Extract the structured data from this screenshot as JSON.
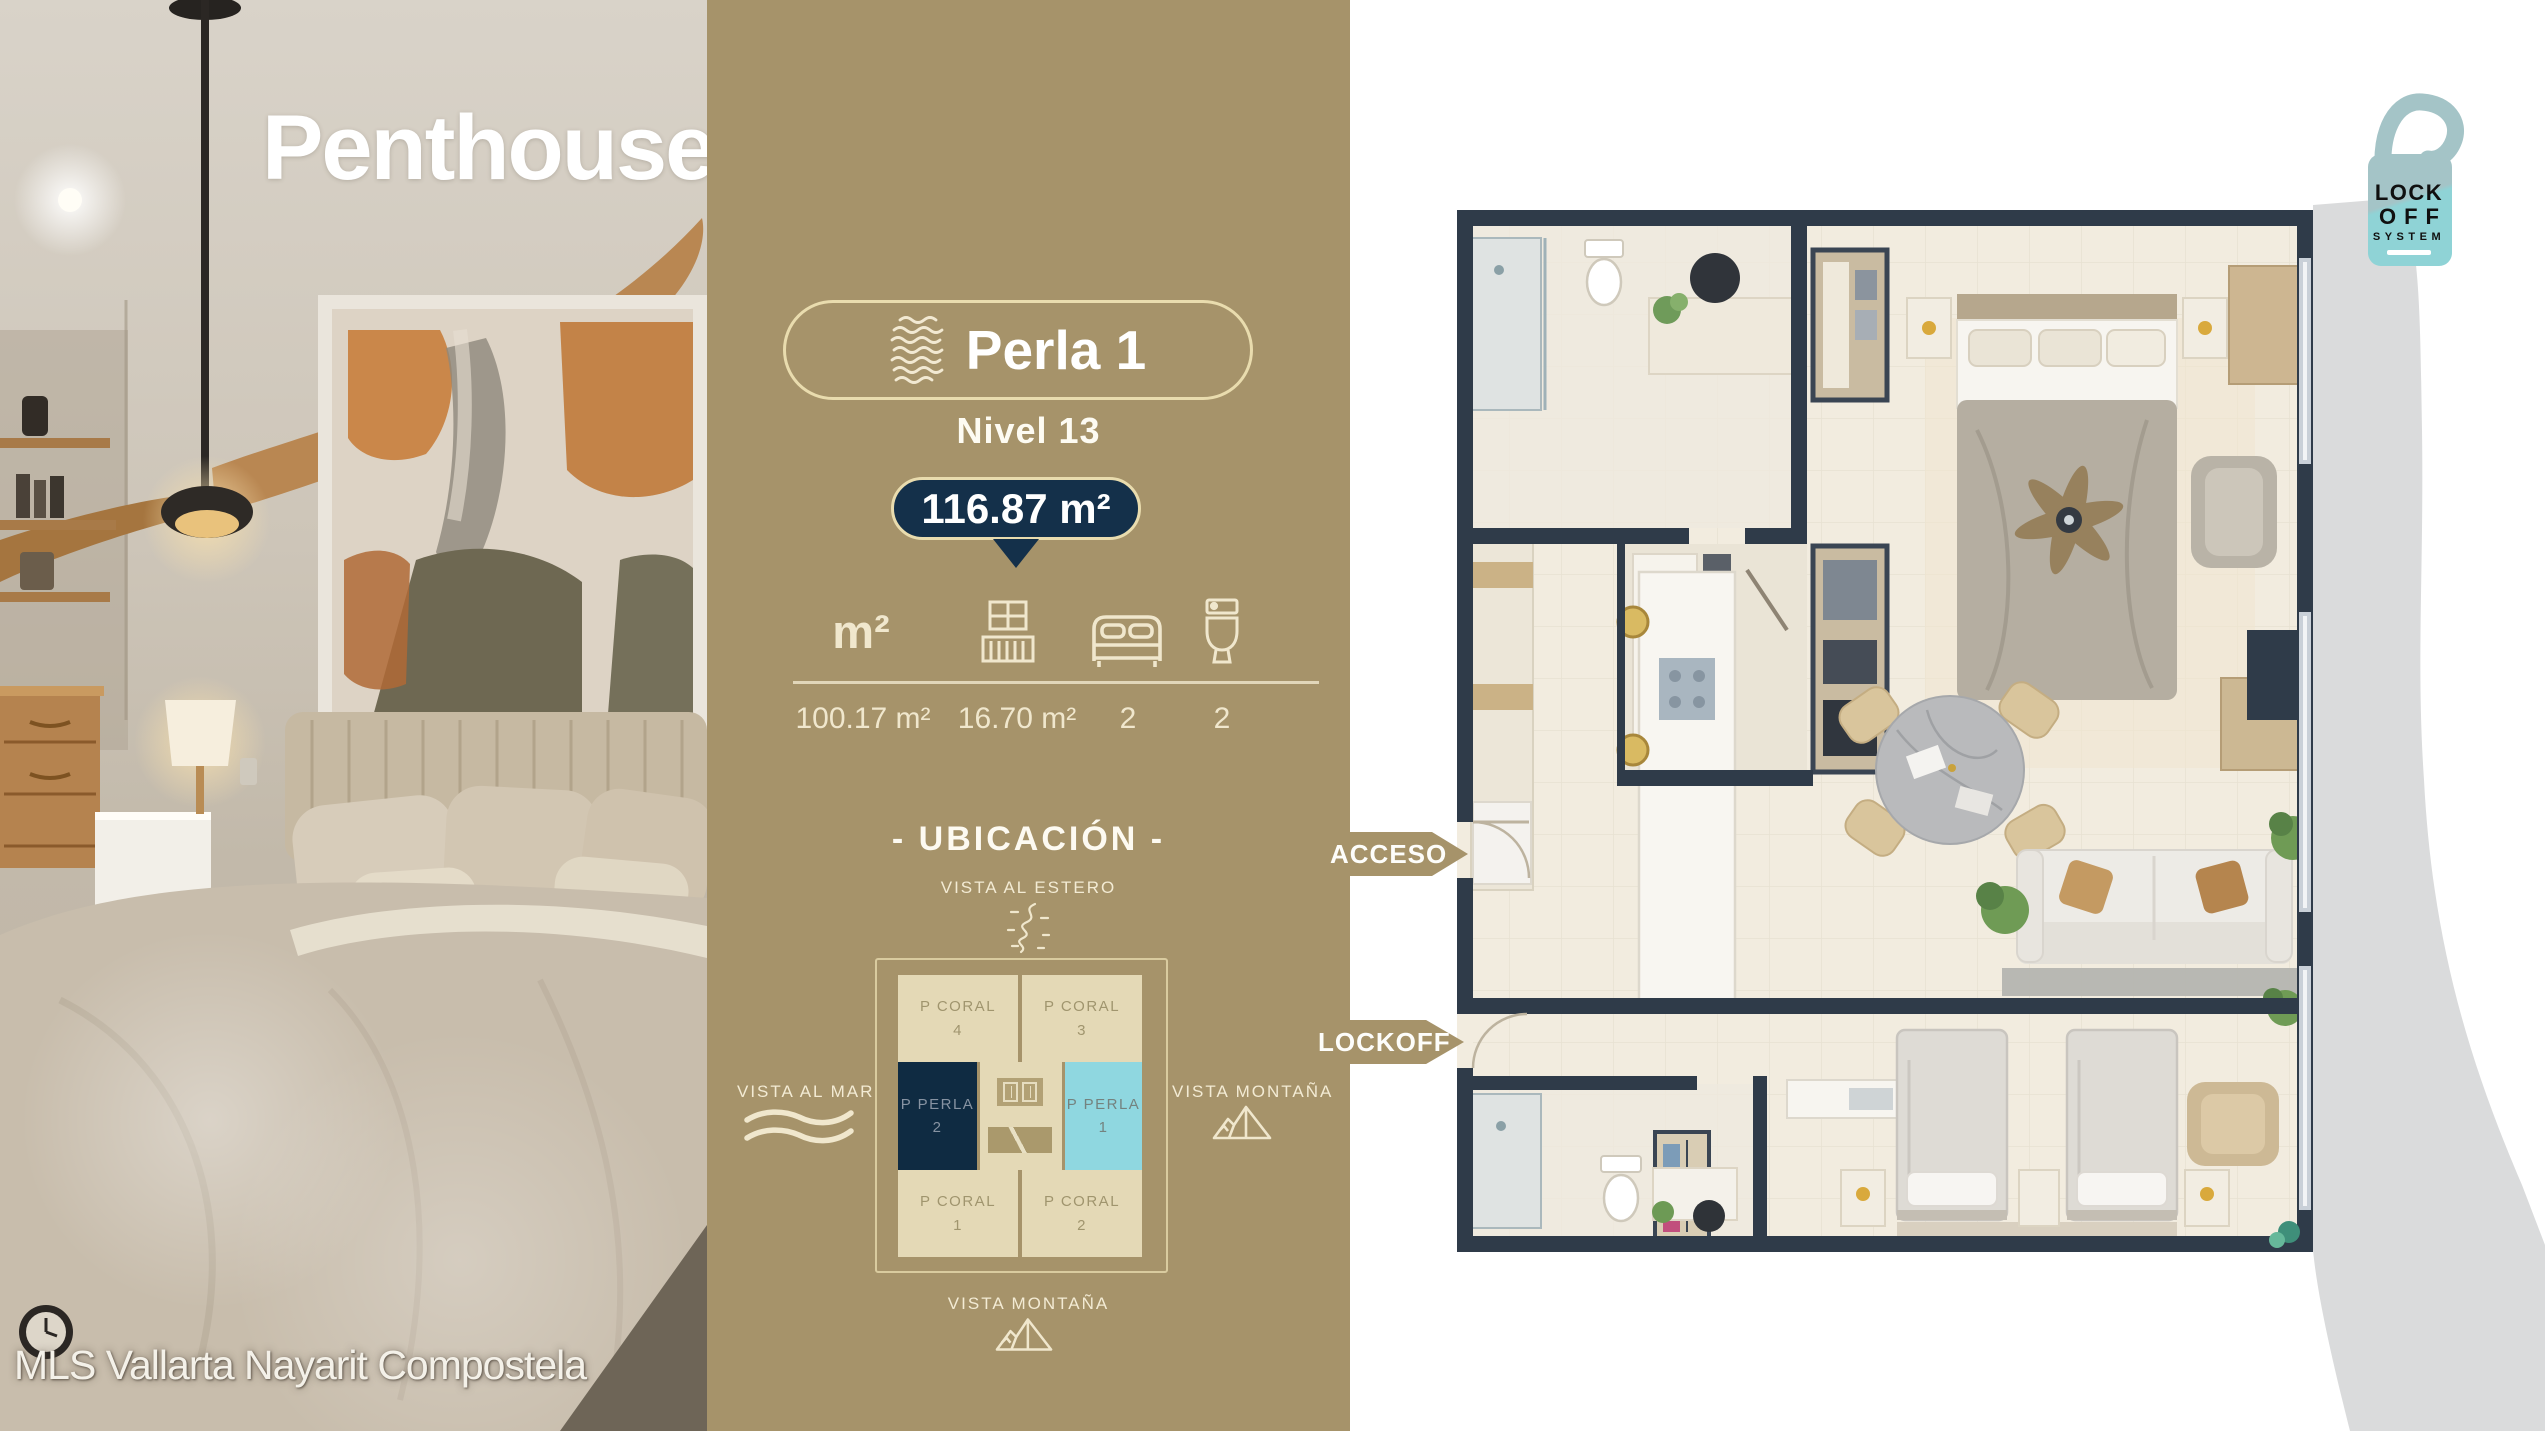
{
  "title": {
    "left": "Penthouse",
    "right": "Perla"
  },
  "watermark": "MLS Vallarta Nayarit Compostela",
  "unit_card": {
    "name": "Perla 1",
    "level": "Nivel 13",
    "total_area": "116.87 m²",
    "stats": [
      {
        "icon": "area-icon",
        "icon_label": "m²",
        "value": "100.17 m²"
      },
      {
        "icon": "balcony-icon",
        "value": "16.70 m²"
      },
      {
        "icon": "bed-icon",
        "value": "2"
      },
      {
        "icon": "toilet-icon",
        "value": "2"
      }
    ]
  },
  "ubicacion": {
    "heading": "- UBICACIÓN -",
    "views": {
      "top": "VISTA AL ESTERO",
      "left": "VISTA AL MAR",
      "right": "VISTA MONTAÑA",
      "bottom": "VISTA MONTAÑA"
    },
    "cells": [
      {
        "label": "P CORAL",
        "number": "4",
        "variant": "coral"
      },
      {
        "label": "P CORAL",
        "number": "3",
        "variant": "coral"
      },
      {
        "label": "P PERLA",
        "number": "2",
        "variant": "perla-dark"
      },
      {
        "label": "P PERLA",
        "number": "1",
        "variant": "perla-light"
      },
      {
        "label": "P CORAL",
        "number": "1",
        "variant": "coral"
      },
      {
        "label": "P CORAL",
        "number": "2",
        "variant": "coral"
      }
    ]
  },
  "floorplan": {
    "acceso": "ACCESO",
    "lockoff": "LOCKOFF",
    "badge": {
      "line1": "LOCK",
      "line2": "OFF",
      "line3": "SYSTEM"
    }
  },
  "colors": {
    "gold": "#a6936a",
    "navy": "#14304a",
    "cyan": "#8fd7e0",
    "beige": "#e4d9b6",
    "cream": "#f0e7cd",
    "wall": "#2f3b49",
    "teal_badge": "#8fd2d5"
  }
}
